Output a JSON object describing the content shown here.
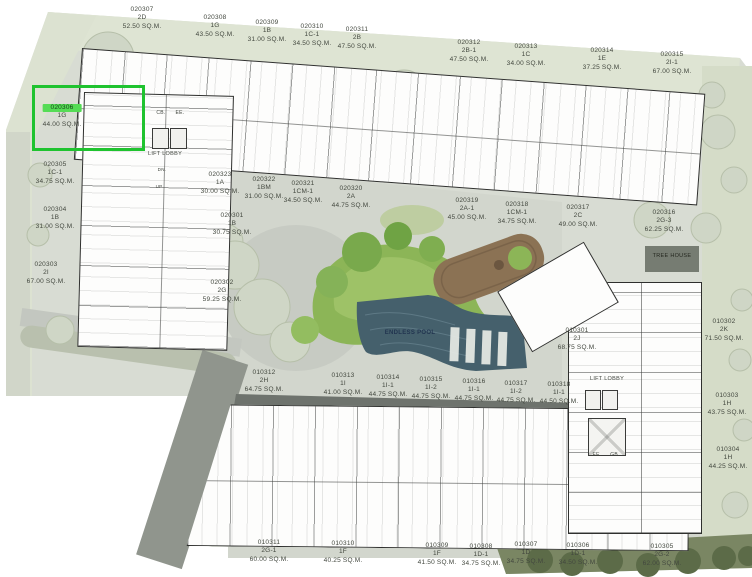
{
  "plan": {
    "title": "site-plan-floor-02",
    "pool_label": "ENDLESS POOL",
    "tree_house_label": "TREE HOUSE",
    "selection": {
      "selected_unit_id": "020306",
      "box_color": "#1fc32f",
      "highlight_color": "#55dc55"
    },
    "colors": {
      "pool": "#45606c",
      "lawn": "#8cb557",
      "deck": "#8b7254",
      "site": "#d8dcd3",
      "walkway_dark": "#6e736d"
    },
    "units": [
      {
        "id": "020307",
        "type": "2D",
        "area": "52.50 SQ.M.",
        "x": 142,
        "y": 6
      },
      {
        "id": "020308",
        "type": "1G",
        "area": "43.50 SQ.M.",
        "x": 215,
        "y": 14
      },
      {
        "id": "020309",
        "type": "1B",
        "area": "31.00 SQ.M.",
        "x": 267,
        "y": 19
      },
      {
        "id": "020310",
        "type": "1C-1",
        "area": "34.50 SQ.M.",
        "x": 312,
        "y": 23
      },
      {
        "id": "020311",
        "type": "2B",
        "area": "47.50 SQ.M.",
        "x": 357,
        "y": 26
      },
      {
        "id": "020312",
        "type": "2B-1",
        "area": "47.50 SQ.M.",
        "x": 469,
        "y": 39
      },
      {
        "id": "020313",
        "type": "1C",
        "area": "34.00 SQ.M.",
        "x": 526,
        "y": 43
      },
      {
        "id": "020314",
        "type": "1E",
        "area": "37.25 SQ.M.",
        "x": 602,
        "y": 47
      },
      {
        "id": "020315",
        "type": "2I-1",
        "area": "67.00 SQ.M.",
        "x": 672,
        "y": 51
      },
      {
        "id": "020306",
        "type": "1G",
        "area": "44.00 SQ.M.",
        "x": 62,
        "y": 104,
        "highlighted": true
      },
      {
        "id": "020305",
        "type": "1C-1",
        "area": "34.75 SQ.M.",
        "x": 55,
        "y": 161
      },
      {
        "id": "020304",
        "type": "1B",
        "area": "31.00 SQ.M.",
        "x": 55,
        "y": 206
      },
      {
        "id": "020303",
        "type": "2I",
        "area": "67.00 SQ.M.",
        "x": 46,
        "y": 261
      },
      {
        "id": "020323",
        "type": "1A",
        "area": "30.00 SQ.M.",
        "x": 220,
        "y": 171
      },
      {
        "id": "020322",
        "type": "1BM",
        "area": "31.00 SQ.M.",
        "x": 264,
        "y": 176
      },
      {
        "id": "020321",
        "type": "1CM-1",
        "area": "34.50 SQ.M.",
        "x": 303,
        "y": 180
      },
      {
        "id": "020320",
        "type": "2A",
        "area": "44.75 SQ.M.",
        "x": 351,
        "y": 185
      },
      {
        "id": "020319",
        "type": "2A-1",
        "area": "45.00 SQ.M.",
        "x": 467,
        "y": 197
      },
      {
        "id": "020318",
        "type": "1CM-1",
        "area": "34.75 SQ.M.",
        "x": 517,
        "y": 201
      },
      {
        "id": "020317",
        "type": "2C",
        "area": "49.00 SQ.M.",
        "x": 578,
        "y": 204
      },
      {
        "id": "020316",
        "type": "2G-3",
        "area": "62.25 SQ.M.",
        "x": 664,
        "y": 209
      },
      {
        "id": "020301",
        "type": "1B",
        "area": "30.75 SQ.M.",
        "x": 232,
        "y": 212
      },
      {
        "id": "020302",
        "type": "2G",
        "area": "59.25 SQ.M.",
        "x": 222,
        "y": 279
      },
      {
        "id": "010301",
        "type": "2J",
        "area": "68.75 SQ.M.",
        "x": 577,
        "y": 327
      },
      {
        "id": "010312",
        "type": "2H",
        "area": "64.75 SQ.M.",
        "x": 264,
        "y": 369
      },
      {
        "id": "010313",
        "type": "1I",
        "area": "41.00 SQ.M.",
        "x": 343,
        "y": 372
      },
      {
        "id": "010314",
        "type": "1I-1",
        "area": "44.75 SQ.M.",
        "x": 388,
        "y": 374
      },
      {
        "id": "010315",
        "type": "1I-2",
        "area": "44.75 SQ.M.",
        "x": 431,
        "y": 376
      },
      {
        "id": "010316",
        "type": "1I-1",
        "area": "44.75 SQ.M.",
        "x": 474,
        "y": 378
      },
      {
        "id": "010317",
        "type": "1I-2",
        "area": "44.75 SQ.M.",
        "x": 516,
        "y": 380
      },
      {
        "id": "010318",
        "type": "1I-1",
        "area": "44.50 SQ.M.",
        "x": 559,
        "y": 381
      },
      {
        "id": "010302",
        "type": "2K",
        "area": "71.50 SQ.M.",
        "x": 724,
        "y": 318
      },
      {
        "id": "010303",
        "type": "1H",
        "area": "43.75 SQ.M.",
        "x": 727,
        "y": 392
      },
      {
        "id": "010304",
        "type": "1H",
        "area": "44.25 SQ.M.",
        "x": 728,
        "y": 446
      },
      {
        "id": "010311",
        "type": "2G-1",
        "area": "60.00 SQ.M.",
        "x": 269,
        "y": 539
      },
      {
        "id": "010310",
        "type": "1F",
        "area": "40.25 SQ.M.",
        "x": 343,
        "y": 540
      },
      {
        "id": "010309",
        "type": "1F",
        "area": "41.50 SQ.M.",
        "x": 437,
        "y": 542
      },
      {
        "id": "010308",
        "type": "1D-1",
        "area": "34.75 SQ.M.",
        "x": 481,
        "y": 543
      },
      {
        "id": "010307",
        "type": "1D",
        "area": "34.75 SQ.M.",
        "x": 526,
        "y": 541
      },
      {
        "id": "010306",
        "type": "1D-1",
        "area": "34.50 SQ.M.",
        "x": 578,
        "y": 542
      },
      {
        "id": "010305",
        "type": "2G-2",
        "area": "62.00 SQ.M.",
        "x": 662,
        "y": 543
      }
    ],
    "misc_labels": [
      {
        "name": "lift-lobby-label-west",
        "text": "LIFT LOBBY",
        "x": 165,
        "y": 151,
        "size": 5.5
      },
      {
        "name": "cb-label-top",
        "text": "CB.",
        "x": 161,
        "y": 110,
        "size": 5
      },
      {
        "name": "ee-label-top",
        "text": "EE.",
        "x": 180,
        "y": 110,
        "size": 5
      },
      {
        "name": "dn-label",
        "text": "DN.",
        "x": 162,
        "y": 167,
        "size": 4.5
      },
      {
        "name": "up-label",
        "text": "UP",
        "x": 159,
        "y": 184,
        "size": 4.5
      },
      {
        "name": "lift-lobby-label-east",
        "text": "LIFT LOBBY",
        "x": 607,
        "y": 376,
        "size": 5.5
      },
      {
        "name": "ee-label-bottom",
        "text": "EE.",
        "x": 597,
        "y": 452,
        "size": 5
      },
      {
        "name": "gb-label-bottom",
        "text": "GB.",
        "x": 615,
        "y": 452,
        "size": 5
      },
      {
        "name": "endless-pool-label",
        "text": "ENDLESS POOL",
        "x": 410,
        "y": 330,
        "size": 6,
        "color": "#223550",
        "bold": true
      },
      {
        "name": "tree-house-label",
        "text": "TREE HOUSE",
        "x": 672,
        "y": 253,
        "size": 5.5,
        "color": "#24271f"
      }
    ]
  }
}
